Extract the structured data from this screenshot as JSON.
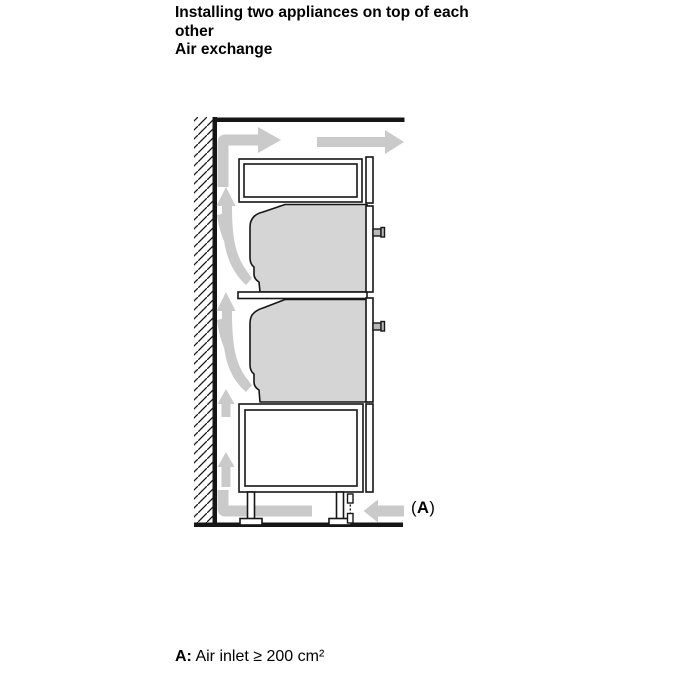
{
  "page": {
    "heading": "Installing two appliances on top of each other",
    "subheading": "Air exchange"
  },
  "figure": {
    "callout": {
      "open_paren": "(",
      "label": "A",
      "close_paren": ")"
    }
  },
  "caption": {
    "label": "A:",
    "text": " Air inlet ≥ 200 cm²"
  },
  "colors": {
    "line": "#161616",
    "oven_fill": "#d5d5d5",
    "arrow_fill": "#cacaca",
    "knob_fill": "#b8b8b8",
    "cabinet_fill": "#ffffff",
    "background": "#ffffff"
  }
}
